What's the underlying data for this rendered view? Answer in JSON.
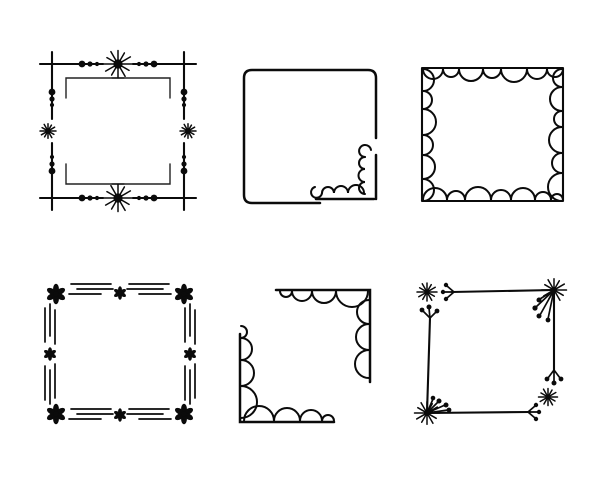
{
  "canvas": {
    "width": 612,
    "height": 490,
    "background_color": "#ffffff",
    "ink_color": "#0b0b0b",
    "description": "Set of six hand-drawn decorative square doodle frames, black ink on white, arranged in two rows of three"
  },
  "grid": {
    "rows": 2,
    "cols": 3,
    "item_count": 6
  },
  "frames": [
    {
      "id": "frame-crossed-corners-stars-dots",
      "label": "Square frame with crossed corner lines, inner corner brackets, dot triplets and starburst accents at edge centers",
      "motifs": [
        "starburst-icon",
        "dot-triplet",
        "corner-cross",
        "corner-bracket"
      ]
    },
    {
      "id": "frame-square-curl-scallop-corner",
      "label": "Plain rounded square frame with a scalloped flourish and two spiral curls in the bottom-right corner",
      "motifs": [
        "spiral-curl-icon",
        "scallop-run"
      ]
    },
    {
      "id": "frame-inner-scallop-border",
      "label": "Square frame lined with inward-facing semicircular scallops of varying size on all four sides",
      "motifs": [
        "scallop-run"
      ]
    },
    {
      "id": "frame-flowers-triple-hatch",
      "label": "Square frame of solid six-petal flowers at corners and edge midpoints joined by triple hatch lines",
      "motifs": [
        "flower-icon",
        "triple-hatch-lines"
      ]
    },
    {
      "id": "frame-scalloped-corner-brackets",
      "label": "Two opposite L-shaped corner brackets (top-right and bottom-left) with inner scallops that shrink away from the corner",
      "motifs": [
        "corner-bracket",
        "scallop-run"
      ]
    },
    {
      "id": "frame-twig-starburst-berries",
      "label": "Hand-drawn square of twig lines with starbursts at two corners, loose asterisk stars at the other two, and berry-spray line endings",
      "motifs": [
        "starburst-icon",
        "asterisk-star-icon",
        "berry-spray-icon"
      ]
    }
  ]
}
